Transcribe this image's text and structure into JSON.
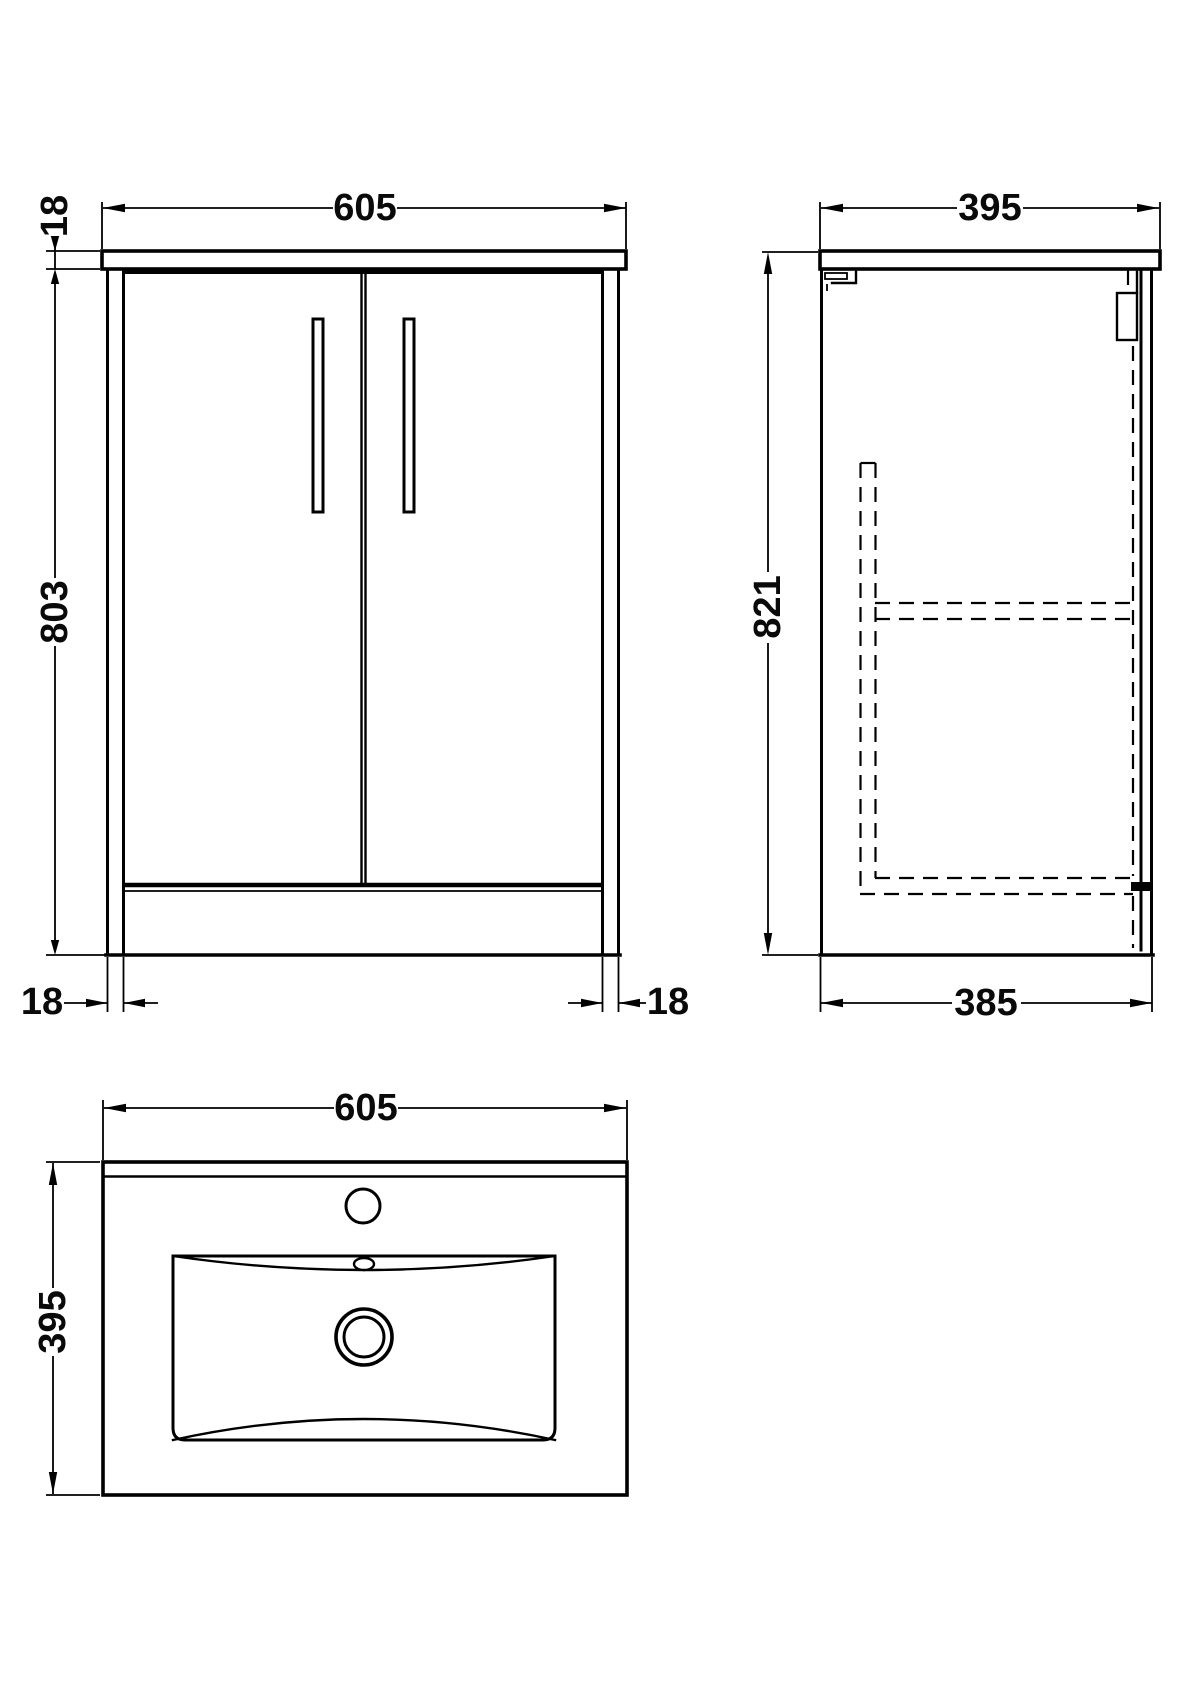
{
  "drawing": {
    "front_view": {
      "width": "605",
      "counter_thickness": "18",
      "body_height": "803",
      "left_leg_width": "18",
      "right_leg_width": "18"
    },
    "side_view": {
      "depth": "395",
      "overall_height": "821",
      "base_depth": "385"
    },
    "top_view": {
      "width": "605",
      "depth": "395"
    },
    "colors": {
      "line": "#000000",
      "background": "#ffffff"
    }
  }
}
